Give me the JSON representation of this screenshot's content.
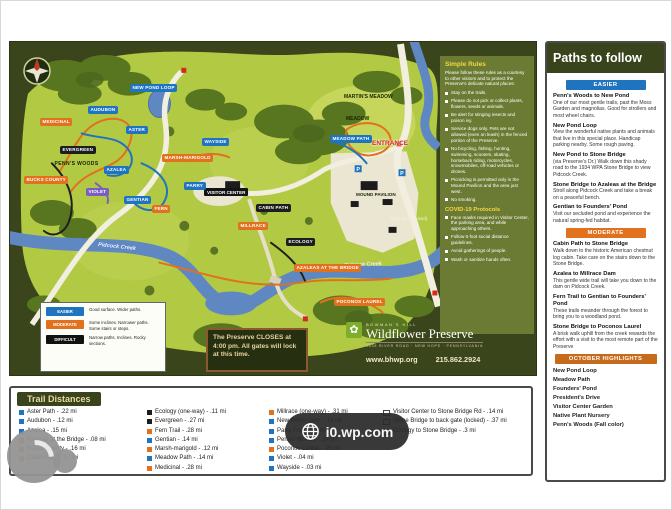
{
  "map": {
    "compass_label": "N",
    "labels": {
      "martins_meadow": "MARTIN'S MEADOW",
      "meadow": "MEADOW",
      "entrance": "ENTRANCE",
      "visitor_center": "VISITOR CENTER",
      "mound_pavilion": "MOUND PAVILION",
      "back_gate": "Back gate (locked)",
      "creek_1": "Pidcock Creek",
      "creek_2": "Pidcock Creek"
    },
    "pills": [
      {
        "text": "NEW POND LOOP",
        "color": "blue"
      },
      {
        "text": "MEADOW PATH",
        "color": "blue"
      },
      {
        "text": "AUDUBON",
        "color": "blue"
      },
      {
        "text": "MEDICINAL",
        "color": "orange"
      },
      {
        "text": "ASTER",
        "color": "blue"
      },
      {
        "text": "EVERGREEN",
        "color": "black"
      },
      {
        "text": "AZALEA",
        "color": "blue"
      },
      {
        "text": "VIOLET",
        "color": "violet"
      },
      {
        "text": "GENTIAN",
        "color": "blue"
      },
      {
        "text": "FERN",
        "color": "orange"
      },
      {
        "text": "MARSH-MARIGOLD",
        "color": "orange"
      },
      {
        "text": "BUCKS COUNTY",
        "color": "orange"
      },
      {
        "text": "PENN'S WOODS",
        "color": "plain"
      },
      {
        "text": "WAYSIDE",
        "color": "blue"
      },
      {
        "text": "PARRY",
        "color": "blue"
      },
      {
        "text": "MILLRACE",
        "color": "orange"
      },
      {
        "text": "ECOLOGY",
        "color": "black"
      },
      {
        "text": "CABIN PATH",
        "color": "black"
      },
      {
        "text": "POCONOS LAUREL",
        "color": "orange"
      },
      {
        "text": "AZALEAS AT THE BRIDGE",
        "color": "orange"
      }
    ],
    "rules": {
      "title": "Simple Rules",
      "intro": "Please follow these rules as a courtesy to other visitors and to protect the Preserve's delicate natural places:",
      "bullets": [
        "Stay on the trails.",
        "Please do not pick or collect plants, flowers, seeds or animals.",
        "Be alert for stinging insects and poison ivy.",
        "Service dogs only. Pets are not allowed (even on leash) in the fenced portion of the Preserve.",
        "No bicycling, fishing, hunting, swimming, scooters, skating, horseback riding, motorcycles, snowmobiles, off-road vehicles or drones.",
        "Picnicking is permitted only in the Mound Pavilion and the area just west.",
        "No smoking."
      ],
      "covid_title": "COVID-19 Protocols",
      "covid_bullets": [
        "Face masks required in Visitor Center, the parking area, and while approaching others.",
        "Follow 6-foot social distance guidelines.",
        "Avoid gatherings of people.",
        "Wash or sanitize hands often."
      ]
    },
    "legend": {
      "easier": {
        "badge": "EASIER",
        "desc": "Good surface. Wider paths."
      },
      "moderate": {
        "badge": "MODERATE",
        "desc": "Some inclines. Narrower paths. Some stairs or steps."
      },
      "difficult": {
        "badge": "DIFFICULT",
        "desc": "Narrow paths. Inclines. Rocky sections."
      }
    },
    "closes_notice": "The Preserve CLOSES at 4:00 pm.  All gates will lock at this time.",
    "logo": {
      "org_small": "BOWMAN'S HILL",
      "org_name": "Wildflower Preserve",
      "tagline": "1635 RIVER ROAD · NEW HOPE · PENNSYLVANIA",
      "website": "www.bhwp.org",
      "phone": "215.862.2924"
    }
  },
  "sidebar": {
    "title": "Paths to follow",
    "easier_badge": "EASIER",
    "easier": [
      {
        "name": "Penn's Woods to New Pond",
        "desc": "One of our most gentle trails, past the Moss Garden and magnolias.  Good for strollers and most wheel chairs."
      },
      {
        "name": "New Pond Loop",
        "desc": "View the wonderful native plants and animals that live in this special place.  Handicap parking nearby.  Some rough paving."
      },
      {
        "name": "New Pond to Stone Bridge",
        "desc": "(via Preserve's Dr.) Walk down this shady road to the 1934 WPA Stone Bridge to view Pidcock Creek."
      },
      {
        "name": "Stone Bridge to Azaleas at the Bridge",
        "desc": "Stroll along Pidcock Creek and take a break on a peaceful bench."
      },
      {
        "name": "Gentian to Founders' Pond",
        "desc": "Visit our secluded pond and experience the natural spring-fed habitat."
      }
    ],
    "moderate_badge": "MODERATE",
    "moderate": [
      {
        "name": "Cabin Path to Stone Bridge",
        "desc": "Walk down to the historic American chestnut log cabin.  Take care on the stairs down to the Stone Bridge."
      },
      {
        "name": "Azalea to Millrace Dam",
        "desc": "This gentle wide trail will take you down to the dam on Pidcock Creek."
      },
      {
        "name": "Fern Trail to Gentian to Founders' Pond",
        "desc": "These trails meander through the forest to bring you to a woodland pond."
      },
      {
        "name": "Stone Bridge to Poconos Laurel",
        "desc": "A brisk walk uphill from the creek rewards the effort with a visit to the most remote part of the Preserve"
      }
    ],
    "october_badge": "OCTOBER HIGHLIGHTS",
    "october": [
      "New Pond Loop",
      "Meadow Path",
      "Founders' Pond",
      "President's Drive",
      "Visitor Center Garden",
      "Native Plant Nursery",
      "Penn's Woods (Fall color)"
    ]
  },
  "trail_distances": {
    "title": "Trail Distances",
    "col1": [
      {
        "c": "blue",
        "t": "Aster Path - .22 mi"
      },
      {
        "c": "blue",
        "t": "Audubon - .12 mi"
      },
      {
        "c": "blue",
        "t": "Azalea - .15 mi"
      },
      {
        "c": "orange",
        "t": "Azaleas at the Bridge - .08 mi"
      },
      {
        "c": "orange",
        "t": "Bucks County - .16 mi"
      },
      {
        "c": "orange",
        "t": "Cabin Path - .07 mi"
      }
    ],
    "col2": [
      {
        "c": "black",
        "t": "Ecology (one-way) - .11 mi"
      },
      {
        "c": "black",
        "t": "Evergreen - .27 mi"
      },
      {
        "c": "orange",
        "t": "Fern Trail - .28 mi"
      },
      {
        "c": "blue",
        "t": "Gentian - .14 mi"
      },
      {
        "c": "orange",
        "t": "Marsh-marigold - .12 mi"
      },
      {
        "c": "blue",
        "t": "Meadow Path - .14 mi"
      },
      {
        "c": "orange",
        "t": "Medicinal - .28 mi"
      }
    ],
    "col3": [
      {
        "c": "orange",
        "t": "Millrace (one-way) - .31 mi"
      },
      {
        "c": "blue",
        "t": "New Pond Loop - .14 mi"
      },
      {
        "c": "blue",
        "t": "Parry Trail - .22 mi"
      },
      {
        "c": "blue",
        "t": "Penn's Woods - .14 mi"
      },
      {
        "c": "orange",
        "t": "Poconos Laurel - .25 mi"
      },
      {
        "c": "blue",
        "t": "Violet - .04 mi"
      },
      {
        "c": "blue",
        "t": "Wayside - .03 mi"
      }
    ],
    "col4": [
      {
        "c": "open",
        "t": "Visitor Center to Stone Bridge Rd - .14 mi"
      },
      {
        "c": "open",
        "t": "Stone Bridge to back gate (locked) - .37 mi"
      },
      {
        "c": "open",
        "t": "Ecology to Stone Bridge - .3 mi"
      }
    ]
  },
  "watermark": {
    "text": "i0.wp.com"
  }
}
